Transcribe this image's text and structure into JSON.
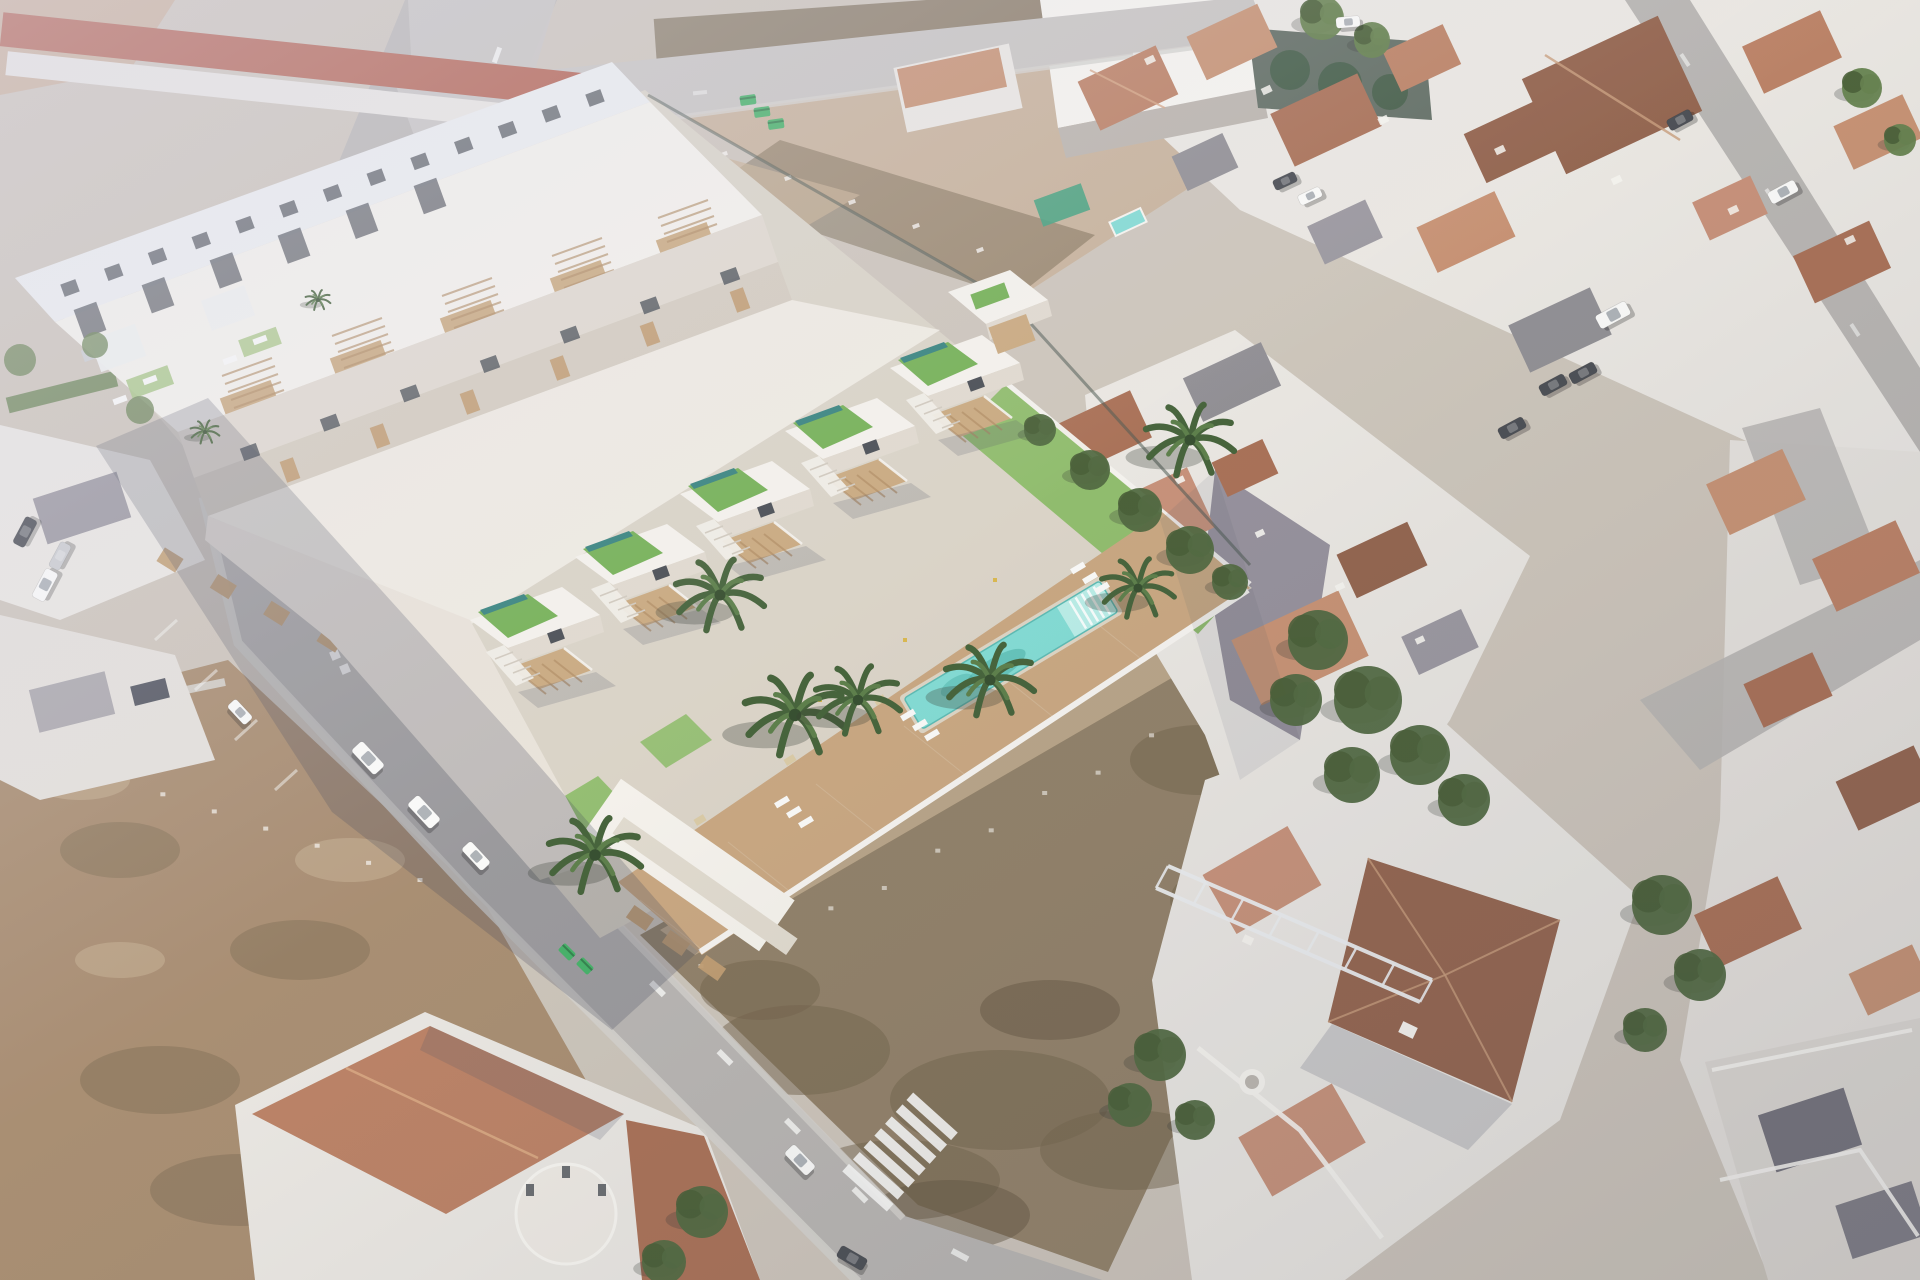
{
  "image": {
    "kind": "aerial-composite-photograph",
    "subject": "Oblique aerial photo of a Spanish coastal town with a 3D architectural render of a new white townhouse development (roof gardens, wood pergolas, communal pool, palm trees) composited over vacant plots",
    "has_text": false
  },
  "palette": {
    "base": "#cbc3b8",
    "dirt_pale": "#c6b098",
    "dirt_pink": "#c9ad96",
    "dirt_scrub": "#8d7c62",
    "dirt_dark": "#6e5e44",
    "dirt_darker": "#5a4c37",
    "dirt_bl": "#a5896c",
    "dirt_patch": "#c4ad8f",
    "road": "#b5b2af",
    "road_light": "#c6c3c0",
    "sidewalk": "#d3d0cb",
    "marking": "#f7f7f5",
    "white_wall": "#e9e6e1",
    "bright_white": "#f6f4ef",
    "wall_shadow": "#b8b2ab",
    "render_white": "#f5f2eb",
    "render_cool": "#eceef0",
    "render_face": "#e0d9cd",
    "render_face2": "#d2cabc",
    "window_dark": "#41464c",
    "pergola": "#c8a67a",
    "pergola_slat": "#ad875b",
    "wood_panel": "#bf9a6d",
    "green_roof": "#6fae4e",
    "green_pale": "#a3c47f",
    "lap_pool": "#2e7d78",
    "pool": "#7edad2",
    "pool_light": "#b7ece6",
    "pool_shadow": "#3da79e",
    "deck": "#c7a47c",
    "deck_light": "#d6b890",
    "grass": "#8cba67",
    "tree_dark": "#4a6339",
    "tree_mid": "#5f7c47",
    "palm_green": "#3e5c32",
    "palm_light": "#567a43",
    "palm_trunk": "#9b8a6d",
    "terra1": "#b97d5f",
    "terra2": "#c58e6e",
    "terra3": "#a66b50",
    "terra4": "#8f5e47",
    "salmon": "#c58d74",
    "red_roof": "#b05a48",
    "gray_roof": "#97949c",
    "gray_dark": "#6f6d76",
    "slate": "#8d8b90",
    "purple_wall": "#928d98",
    "fence": "#45524a",
    "tarp": "#3e9e7a",
    "bin_green": "#3fae62",
    "car_white": "#fafaf8",
    "car_gray": "#c9cbce",
    "truss": "#eceef0",
    "yellow": "#d8b548",
    "shadow_soft": "rgba(72,74,96,0.20)",
    "shadow_mid": "rgba(60,62,82,0.25)"
  },
  "scene": {
    "development": {
      "townhouse_units_visible": 6,
      "back_apartment_block": 1,
      "roof_gardens": 8,
      "roof_lap_pools": 5,
      "wood_pergolas": 11,
      "communal_pool": {
        "color_key": "pool",
        "step_lines": 5,
        "orientation_deg": -31
      },
      "wood_deck": true,
      "palm_trees": 9,
      "sun_loungers": 13,
      "perimeter_wall": true,
      "garden_trees": 5
    },
    "surroundings": {
      "vacant_dirt_lots": 3,
      "streets_visible": 5,
      "zebra_crossings": 1,
      "zebra_bars": 7,
      "terracotta_roofs": 31,
      "parked_vehicles": {
        "white": 10,
        "dark": 7,
        "gray": 3
      },
      "green_dumpsters": 5,
      "neighbor_rooftop_pool": 1,
      "white_lattice_truss_on_lot": 1,
      "red_gable_warehouse_roof": 1,
      "walled_dark_garden": 1
    }
  }
}
